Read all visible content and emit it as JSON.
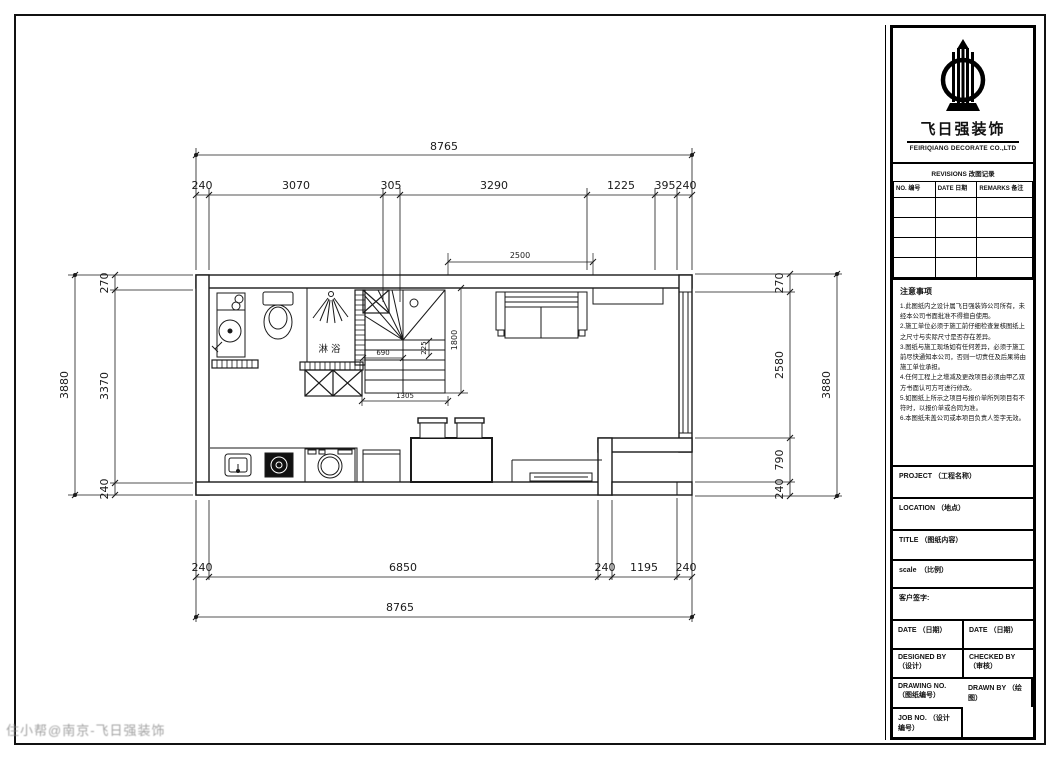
{
  "watermark": "住小帮@南京-飞日强装饰",
  "title_block": {
    "company_cn": "飞日强装饰",
    "company_en": "FEIRIQIANG DECORATE CO.,LTD",
    "revisions": {
      "title": "REVISIONS 改图记录",
      "col_no": "NO. 编号",
      "col_date": "DATE 日期",
      "col_remarks": "REMARKS 备注"
    },
    "notes_title": "注意事项",
    "notes": [
      "1.此图纸内之设计属飞日强装饰公司所有，未经本公司书面批准不得擅自使用。",
      "2.施工单位必须于施工前仔细检查复核图纸上之尺寸与实际尺寸是否存在差异。",
      "3.图纸与施工现场如有任何差异，必须于施工前尽快通知本公司，否则一切责任及后果将由施工单位承担。",
      "4.任何工程上之增减及更改项目必须由甲乙双方书面认可方可进行修改。",
      "5.如图纸上所示之项目与报价单所列项目有不符时，以报价单或合同为准。",
      "6.本图纸未盖公司或本项目负责人签字无效。"
    ],
    "fields": {
      "project": "PROJECT （工程名称）",
      "location": "LOCATION （地点）",
      "title": "TITLE （图纸内容）",
      "scale": "scale　（比例）",
      "client_sign": "客户签字:",
      "date_left": "DATE （日期）",
      "date_right": "DATE （日期）",
      "designed_by": "DESIGNED BY （设计）",
      "checked_by": "CHECKED BY （审核）",
      "drawn_by": "DRAWN BY （绘图）",
      "drawing_no": "DRAWING NO. （图纸编号）",
      "job_no": "JOB NO. （设计编号）"
    }
  },
  "plan": {
    "labels": {
      "shower": "淋浴"
    },
    "dims": {
      "top_overall": "8765",
      "top": [
        "240",
        "3070",
        "305",
        "3290",
        "1225",
        "395",
        "240"
      ],
      "bottom": [
        "240",
        "6850",
        "240",
        "1195",
        "240"
      ],
      "bottom_overall": "8765",
      "left_overall": "3880",
      "left": [
        "270",
        "3370",
        "240"
      ],
      "right": [
        "270",
        "2580",
        "790",
        "240"
      ],
      "right_overall": "3880",
      "stairs": {
        "width": "2500",
        "depth": "1800",
        "tread": "690",
        "riser": "225",
        "run": "1305"
      }
    }
  }
}
